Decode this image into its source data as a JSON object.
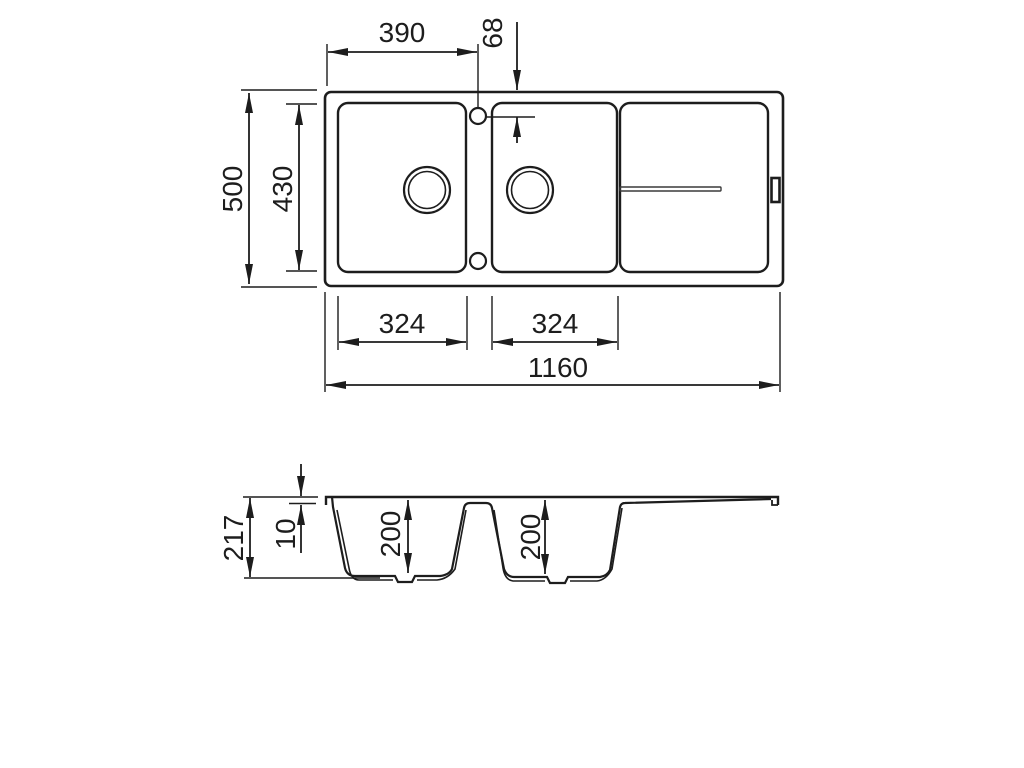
{
  "diagram": {
    "type": "technical-drawing",
    "subject": "double-bowl kitchen sink with drainer board",
    "units": "mm",
    "top_view": {
      "dimensions": {
        "tap_hole_offset_x": "390",
        "tap_hole_offset_y": "68",
        "overall_depth": "500",
        "inner_depth": "430",
        "bowl1_width": "324",
        "bowl2_width": "324",
        "overall_width": "1160"
      }
    },
    "section_view": {
      "dimensions": {
        "overall_height": "217",
        "rim_thickness": "10",
        "bowl1_depth": "200",
        "bowl2_depth": "200"
      }
    },
    "colors": {
      "line": "#1d1d1d",
      "background": "#ffffff"
    }
  }
}
